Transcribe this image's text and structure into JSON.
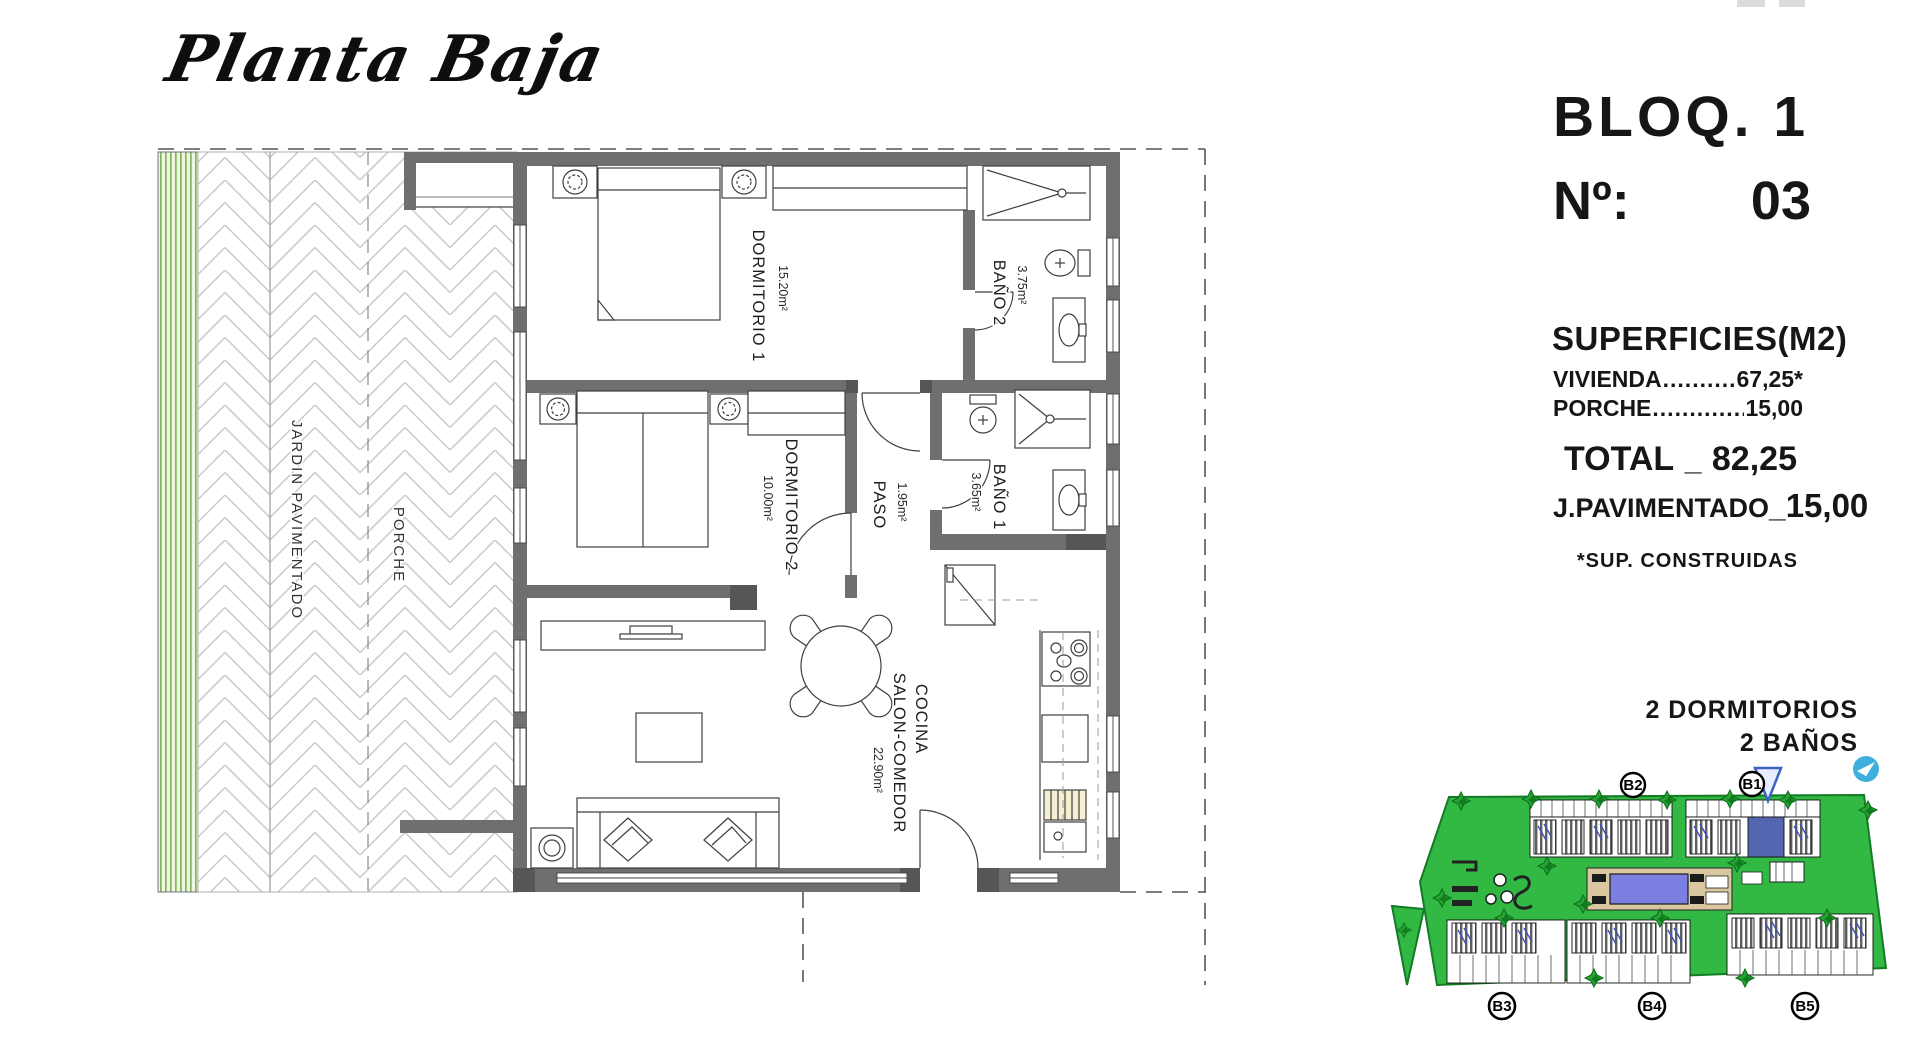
{
  "title": "Planta Baja",
  "panel": {
    "bloq": "BLOQ. 1",
    "num_label": "Nº:",
    "num_value": "03",
    "superficies_title": "SUPERFICIES(M2)",
    "rows": [
      {
        "label": "VIVIENDA",
        "leader": "......................",
        "value": "67,25*"
      },
      {
        "label": "PORCHE",
        "leader": "......................",
        "value": "15,00"
      }
    ],
    "total_label": "TOTAL",
    "total_sep": "_",
    "total_value": "82,25",
    "pav_label": "J.PAVIMENTADO",
    "pav_sep": "_",
    "pav_value": "15,00",
    "footnote": "*SUP. CONSTRUIDAS",
    "features": [
      "2 DORMITORIOS",
      "2 BAÑOS"
    ]
  },
  "floorplan": {
    "outdoor": {
      "jardin": "JARDIN PAVIMENTADO",
      "porche": "PORCHE"
    },
    "rooms": [
      {
        "name": "DORMITORIO 1",
        "area": "15.20m²"
      },
      {
        "name": "BAÑO 2",
        "area": "3.75m²"
      },
      {
        "name": "DORMITORIO 2",
        "area": "10.00m²"
      },
      {
        "name": "PASO",
        "area": "1.95m²"
      },
      {
        "name": "BAÑO 1",
        "area": "3.65m²"
      },
      {
        "name": "COCINA",
        "name2": "SALON-COMEDOR",
        "area": "22.90m²"
      }
    ]
  },
  "siteplan": {
    "blocks": [
      "B2",
      "B1",
      "B3",
      "B4",
      "B5"
    ]
  }
}
